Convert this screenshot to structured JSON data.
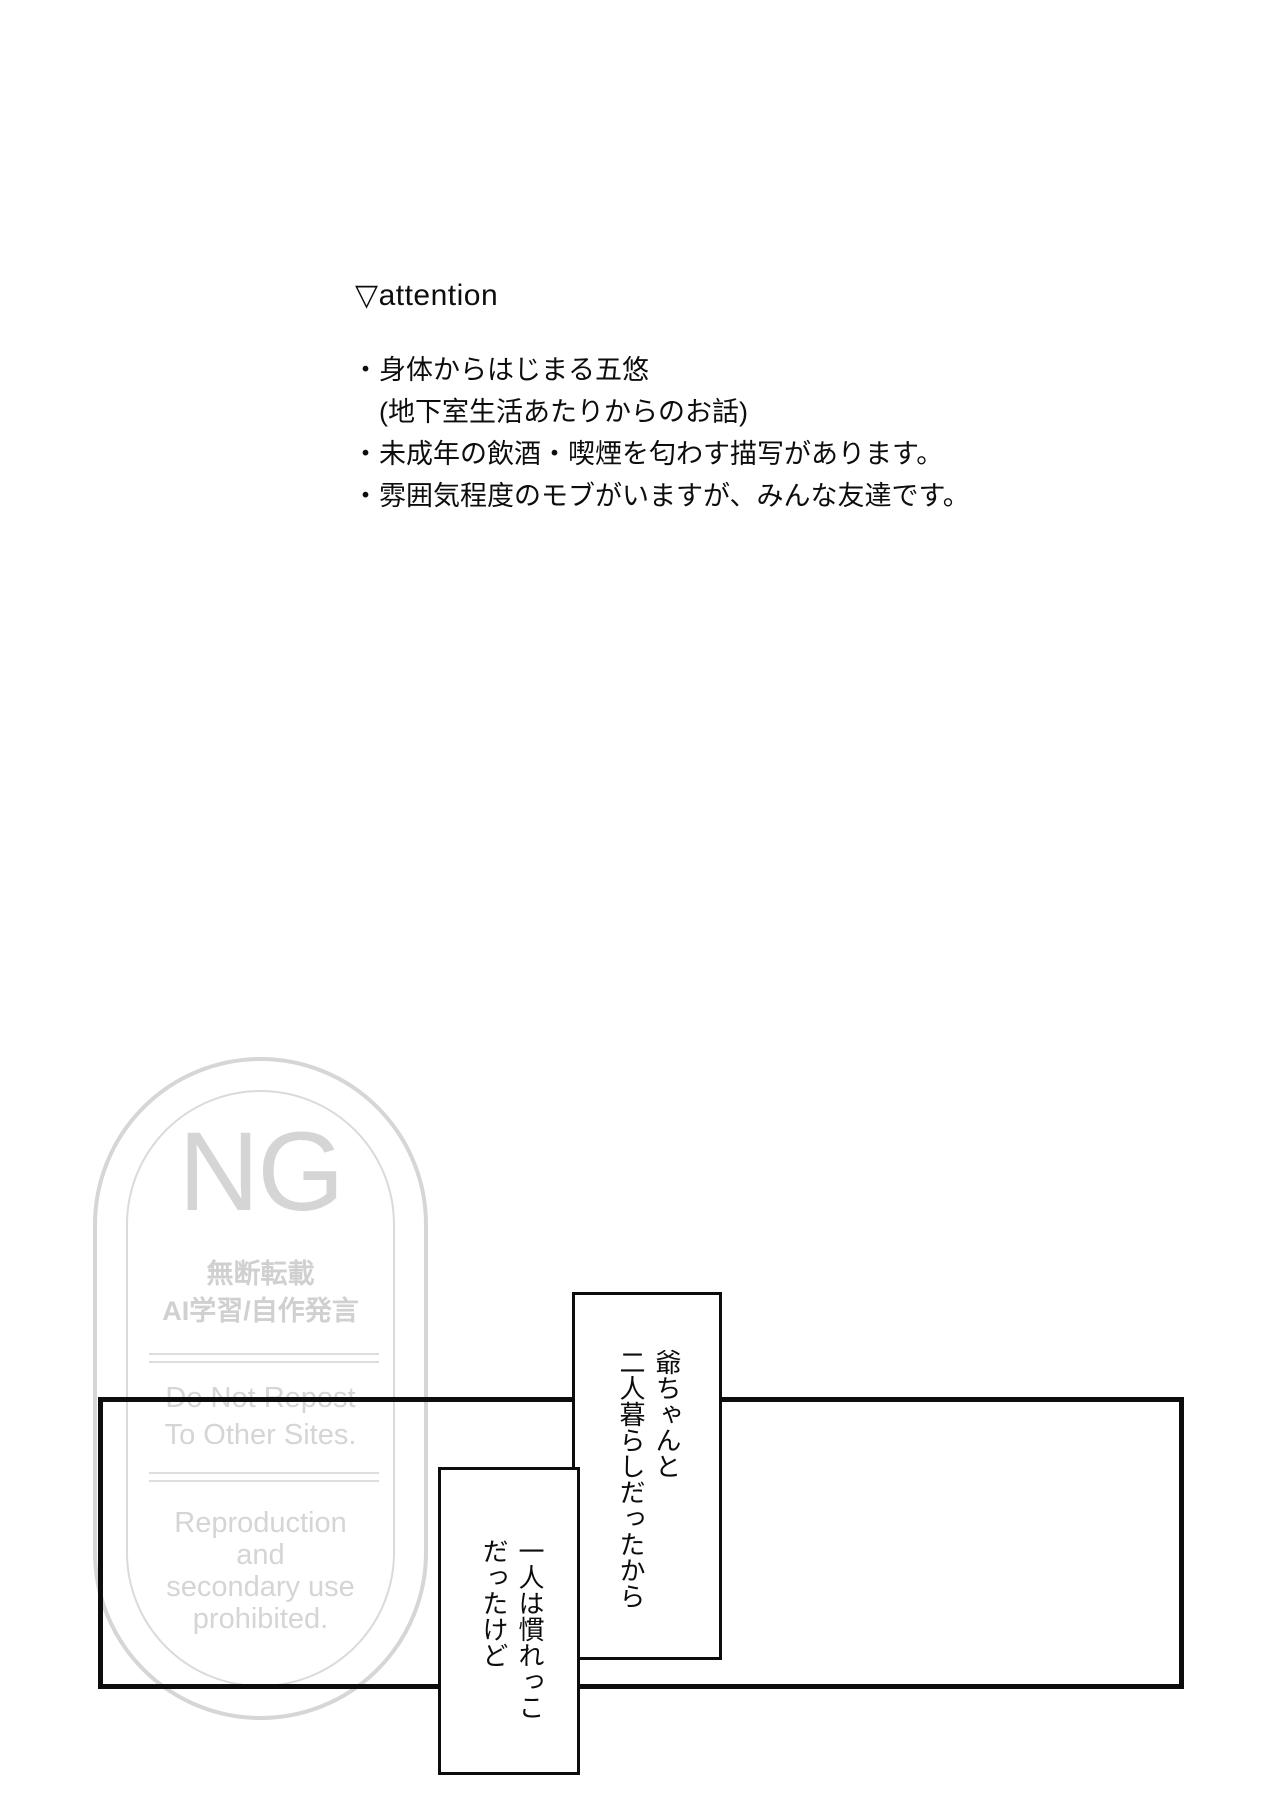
{
  "ink_color": "#0d0d0d",
  "attention": {
    "heading": "▽attention",
    "items": [
      "・身体からはじまる五悠",
      "　(地下室生活あたりからのお話)",
      "・未成年の飲酒・喫煙を匂わす描写があります。",
      "・雰囲気程度のモブがいますが、みんな友達です。"
    ]
  },
  "watermark": {
    "color": "#d3d3d3",
    "ng_label": "NG",
    "ja_line1": "無断転載",
    "ja_line2": "AI学習/自作発言",
    "en_block1": "Do Not Repost\nTo Other Sites.",
    "en_block2": "Reproduction\nand\nsecondary use\nprohibited."
  },
  "comic": {
    "bubble_right_text": "爺ちゃんと\n二人暮らしだったから",
    "bubble_left_text": "一人は慣れっこ\nだったけど"
  }
}
